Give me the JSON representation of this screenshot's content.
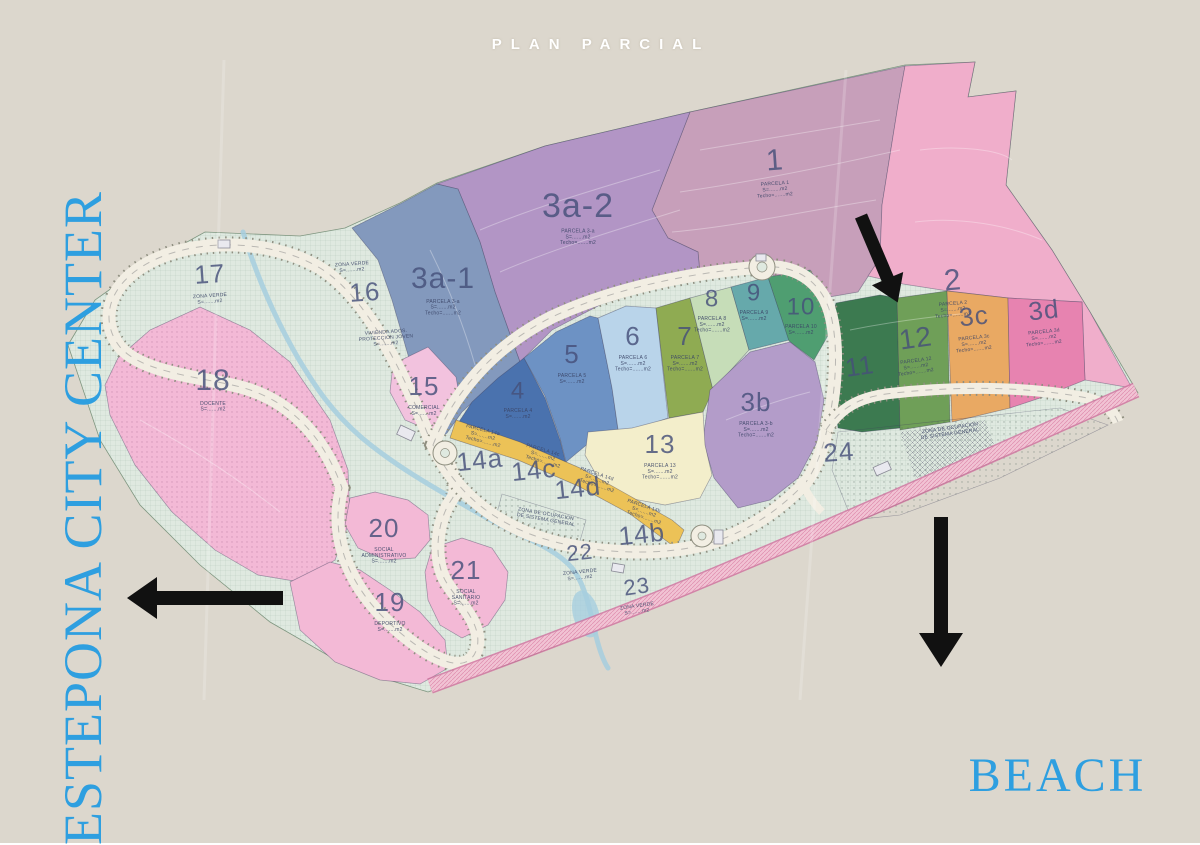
{
  "title": "PLAN PARCIAL",
  "corner_labels": {
    "city_center": "ESTEPONA CITY CENTER",
    "beach": "BEACH"
  },
  "arrows": [
    {
      "name": "arrow-site-entrance",
      "direction": "down-right"
    },
    {
      "name": "arrow-estepona-city-center",
      "direction": "left"
    },
    {
      "name": "arrow-beach",
      "direction": "down"
    }
  ],
  "colors": {
    "background": "#dcd7cd",
    "terrain": "#dfe9e0",
    "road": "#f2eee3",
    "road_edge": "#8f8f80",
    "stream": "#a6cede",
    "highway": "#f1c3d4",
    "highway_edge": "#cf6f9d",
    "label": "#46507a",
    "sublabel": "#3a4466",
    "blue_text": "#2e9fe0",
    "arrow": "#111111",
    "p1": "#c79fba",
    "p2": "#f0aecb",
    "p3a1": "#8399bd",
    "p3a2": "#b295c5",
    "p3b": "#b39cc9",
    "p3c": "#e9a963",
    "p3d": "#e783b0",
    "p4": "#4a72ae",
    "p5": "#6d92c4",
    "p6": "#b9d4ea",
    "p7": "#8fab52",
    "p8": "#c6ddb8",
    "p9": "#66a9ab",
    "p10": "#4f9e71",
    "p11": "#3c7a50",
    "p12": "#6f9f58",
    "p13": "#f3eecb",
    "p14": "#ecc257",
    "p15": "#f2c2de",
    "p18": "#f3b9d6",
    "p19": "#f3b9d6",
    "p20": "#f3b9d6",
    "p21": "#f3b9d6"
  },
  "parcels": [
    {
      "label": "1",
      "x": 775,
      "y": 162,
      "size": 30,
      "rot": -4,
      "sub": [
        "PARCELA 1",
        "S=.......m2",
        "Techo=.......m2"
      ]
    },
    {
      "label": "2",
      "x": 953,
      "y": 282,
      "size": 30,
      "rot": -5,
      "sub": [
        "PARCELA 2",
        "S=.......m2",
        "Techo=.......m2"
      ]
    },
    {
      "label": "3a-2",
      "x": 578,
      "y": 208,
      "size": 34,
      "rot": 0,
      "sub": [
        "PARCELA 3-a",
        "S=.......m2",
        "Techo=.......m2"
      ]
    },
    {
      "label": "3a-1",
      "x": 443,
      "y": 280,
      "size": 30,
      "rot": 0,
      "sub": [
        "PARCELA 3-a",
        "S=.......m2",
        "Techo=.......m2"
      ]
    },
    {
      "label": "4",
      "x": 518,
      "y": 392,
      "size": 24,
      "rot": 0,
      "sub": [
        "PARCELA 4",
        "S=.......m2"
      ]
    },
    {
      "label": "5",
      "x": 572,
      "y": 356,
      "size": 26,
      "rot": 0,
      "sub": [
        "PARCELA 5",
        "S=.......m2"
      ]
    },
    {
      "label": "6",
      "x": 633,
      "y": 338,
      "size": 26,
      "rot": 0,
      "sub": [
        "PARCELA 6",
        "S=.......m2",
        "Techo=.......m2"
      ]
    },
    {
      "label": "7",
      "x": 685,
      "y": 338,
      "size": 26,
      "rot": 0,
      "sub": [
        "PARCELA 7",
        "S=.......m2",
        "Techo=.......m2"
      ]
    },
    {
      "label": "8",
      "x": 712,
      "y": 300,
      "size": 24,
      "rot": 0,
      "sub": [
        "PARCELA 8",
        "S=.......m2",
        "Techo=.......m2"
      ]
    },
    {
      "label": "9",
      "x": 754,
      "y": 294,
      "size": 24,
      "rot": 0,
      "sub": [
        "PARCELA 9",
        "S=.......m2"
      ]
    },
    {
      "label": "10",
      "x": 801,
      "y": 308,
      "size": 24,
      "rot": 0,
      "sub": [
        "PARCELA 10",
        "S=.......m2"
      ]
    },
    {
      "label": "11",
      "x": 860,
      "y": 368,
      "size": 26,
      "rot": -8
    },
    {
      "label": "12",
      "x": 916,
      "y": 340,
      "size": 28,
      "rot": -8,
      "sub": [
        "PARCELA 12",
        "S=.......m2",
        "Techo=.......m2"
      ]
    },
    {
      "label": "3c",
      "x": 974,
      "y": 318,
      "size": 26,
      "rot": -6,
      "sub": [
        "PARCELA 3c",
        "S=.......m2",
        "Techo=.......m2"
      ]
    },
    {
      "label": "3d",
      "x": 1044,
      "y": 312,
      "size": 26,
      "rot": -6,
      "sub": [
        "PARCELA 3d",
        "S=.......m2",
        "Techo=.......m2"
      ]
    },
    {
      "label": "3b",
      "x": 756,
      "y": 404,
      "size": 26,
      "rot": 0,
      "sub": [
        "PARCELA 3-b",
        "S=.......m2",
        "Techo=.......m2"
      ]
    },
    {
      "label": "13",
      "x": 660,
      "y": 446,
      "size": 26,
      "rot": 0,
      "sub": [
        "PARCELA 13",
        "S=.......m2",
        "Techo=.......m2"
      ]
    },
    {
      "label": "14a",
      "x": 480,
      "y": 462,
      "size": 26,
      "rot": -6
    },
    {
      "label": "14c",
      "x": 534,
      "y": 472,
      "size": 26,
      "rot": -6
    },
    {
      "label": "14d",
      "x": 578,
      "y": 490,
      "size": 26,
      "rot": -6
    },
    {
      "label": "14b",
      "x": 642,
      "y": 536,
      "size": 26,
      "rot": -6
    },
    {
      "label": "15",
      "x": 424,
      "y": 388,
      "size": 26,
      "rot": 0,
      "sub": [
        "COMERCIAL",
        "S=.......m2"
      ]
    },
    {
      "label": "16",
      "x": 365,
      "y": 294,
      "size": 26,
      "rot": -4
    },
    {
      "label": "17",
      "x": 210,
      "y": 276,
      "size": 26,
      "rot": -4,
      "sub": [
        "ZONA VERDE",
        "S=.......m2"
      ]
    },
    {
      "label": "18",
      "x": 213,
      "y": 382,
      "size": 30,
      "rot": 0,
      "sub": [
        "DOCENTE",
        "S=.......m2"
      ]
    },
    {
      "label": "19",
      "x": 390,
      "y": 604,
      "size": 26,
      "rot": 0,
      "sub": [
        "DEPORTIVO",
        "S=.......m2"
      ]
    },
    {
      "label": "20",
      "x": 384,
      "y": 530,
      "size": 26,
      "rot": 0,
      "sub": [
        "SOCIAL",
        "ADMINISTRATIVO",
        "S=.......m2"
      ]
    },
    {
      "label": "21",
      "x": 466,
      "y": 572,
      "size": 26,
      "rot": 0,
      "sub": [
        "SOCIAL",
        "SANITARIO",
        "S=.......m2"
      ]
    },
    {
      "label": "22",
      "x": 580,
      "y": 554,
      "size": 22,
      "rot": -6,
      "sub": [
        "ZONA VERDE",
        "S=.......m2"
      ]
    },
    {
      "label": "23",
      "x": 637,
      "y": 588,
      "size": 22,
      "rot": -8,
      "sub": [
        "ZONA VERDE",
        "S=.......m2"
      ]
    },
    {
      "label": "24",
      "x": 839,
      "y": 454,
      "size": 26,
      "rot": -4
    }
  ],
  "annotations": [
    {
      "lines": [
        "ZONA VERDE",
        "S=.......m2"
      ],
      "x": 352,
      "y": 264,
      "rot": -4
    },
    {
      "lines": [
        "VIVIENDA ADOS.",
        "PROTECCION JOVEN",
        "S=.......m2"
      ],
      "x": 386,
      "y": 332,
      "rot": -4
    },
    {
      "lines": [
        "PARCELA 14a",
        "S=.......m2",
        "Techo=.......m2"
      ],
      "x": 483,
      "y": 430,
      "rot": 14
    },
    {
      "lines": [
        "PARCELA 14c",
        "S=.......m2",
        "Techo=.......m2"
      ],
      "x": 543,
      "y": 450,
      "rot": 16
    },
    {
      "lines": [
        "PARCELA 14d",
        "S=.......m2",
        "Techo=.......m2"
      ],
      "x": 597,
      "y": 474,
      "rot": 18
    },
    {
      "lines": [
        "PARCELA 14b",
        "S=.......m2",
        "Techo=.......m2"
      ],
      "x": 644,
      "y": 506,
      "rot": 18
    },
    {
      "lines": [
        "ZONA DE OCUPACION",
        "DE SISTEMA GENERAL"
      ],
      "x": 950,
      "y": 428,
      "rot": -8
    },
    {
      "lines": [
        "ZONA DE OCUPACION",
        "DE SISTEMA GENERAL"
      ],
      "x": 546,
      "y": 514,
      "rot": 10
    }
  ]
}
